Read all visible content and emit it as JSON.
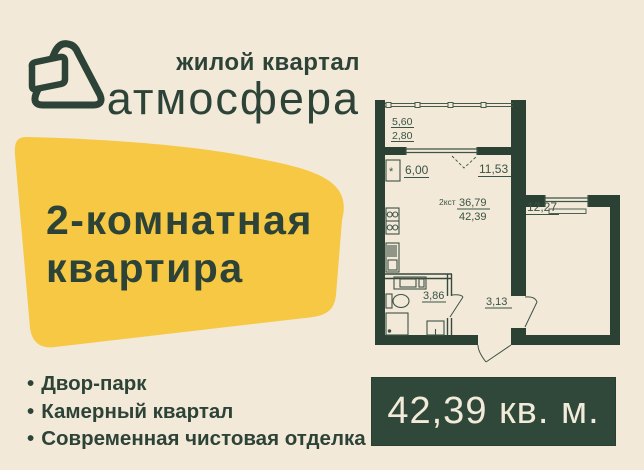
{
  "colors": {
    "background": "#f2e9d9",
    "accent_yellow": "#f6c843",
    "dark_green_text": "#2e4337",
    "wall_green": "#2b4134",
    "badge_background": "#2f4839",
    "badge_text": "#f3ebd9"
  },
  "logo": {
    "tagline": "жилой квартал",
    "brand": "атмосфера"
  },
  "banner": {
    "line1": "2-комнатная",
    "line2": "квартира"
  },
  "floor_plan": {
    "unit_label": "2кст",
    "area_living": "36,79",
    "area_total": "42,39",
    "balcony_dim1": "5,60",
    "balcony_dim2": "2,80",
    "kitchen_area": "6,00",
    "living_area": "11,53",
    "bedroom_area": "12,27",
    "bathroom_area": "3,86",
    "hallway_area": "3,13",
    "fridge_symbol": "*"
  },
  "features": {
    "bullet": "•",
    "items": [
      "Двор-парк",
      "Камерный квартал",
      "Современная чистовая отделка"
    ]
  },
  "badge": {
    "area_label": "42,39 кв. м."
  }
}
